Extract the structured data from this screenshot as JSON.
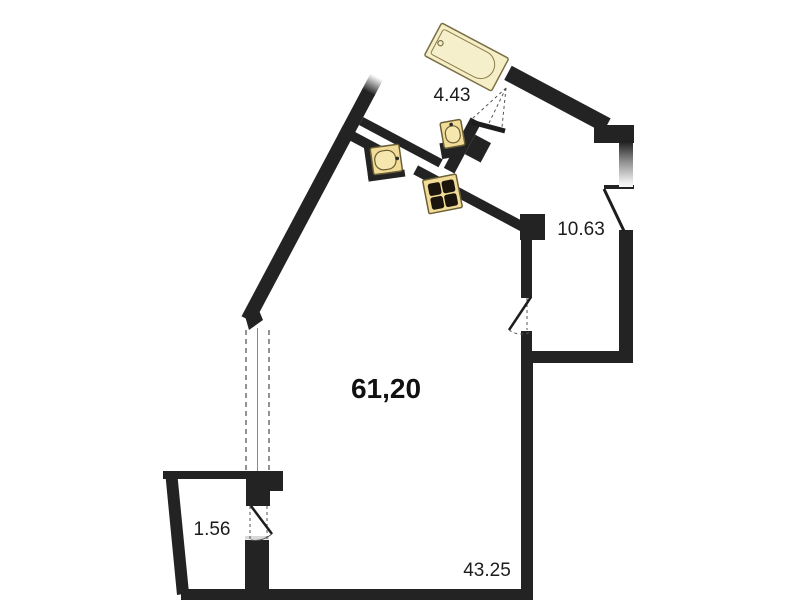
{
  "floorplan": {
    "area_labels": {
      "bathroom": "4.43",
      "hall": "10.63",
      "studio_total": "61,20",
      "balcony": "1.56",
      "living_zone": "43.25"
    },
    "fixtures": {
      "bathtub": "bathtub",
      "small_washbasin": "washbasin",
      "large_washbasin": "washbasin",
      "stove": "four-burner-stove"
    },
    "colors": {
      "wall": "#232323",
      "fixture_fill": "#f2dc97",
      "fixture_fill_light": "#f5eec6",
      "fixture_outline": "#6b6036",
      "burner": "#1b150d",
      "label": "#1c1c1c",
      "background": "#ffffff"
    }
  }
}
